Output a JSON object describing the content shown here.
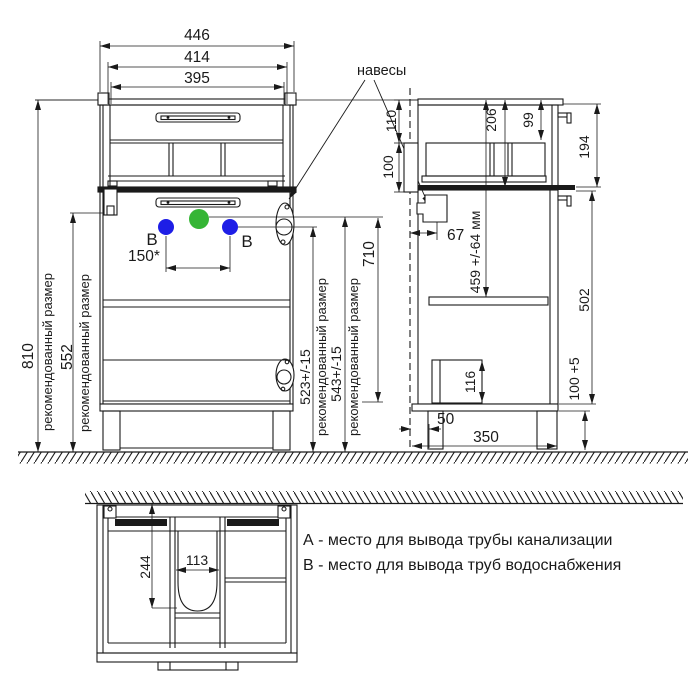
{
  "page": {
    "bg": "#ffffff",
    "ink": "#1a1a1a"
  },
  "colors": {
    "water_outlet_blue": "#1e1ee6",
    "drain_outlet_green": "#35b535"
  },
  "front_view": {
    "width_overall": "446",
    "width_mid": "414",
    "width_inner": "395",
    "height_810": "810",
    "height_552": "552",
    "recommended_label": "рекомендованный размер",
    "outlet_spacing": "150*",
    "outlet_label_left": "В",
    "outlet_label_right": "В",
    "height_523": "523+/-15",
    "height_543": "543+/-15",
    "height_710": "710",
    "hangers_label": "навесы"
  },
  "side_view": {
    "dim_110": "110",
    "dim_100": "100",
    "dim_206": "206",
    "dim_99": "99",
    "dim_194": "194",
    "dim_67": "67",
    "dim_459": "459 +/-64 мм",
    "dim_502": "502",
    "dim_116": "116",
    "dim_50": "50",
    "dim_350": "350",
    "dim_100_plus_5": "100 +5"
  },
  "top_view": {
    "dim_244": "244",
    "dim_113": "113"
  },
  "legend": {
    "line_a": "А - место для вывода трубы канализации",
    "line_b": "В - место для вывода труб водоснабжения"
  }
}
